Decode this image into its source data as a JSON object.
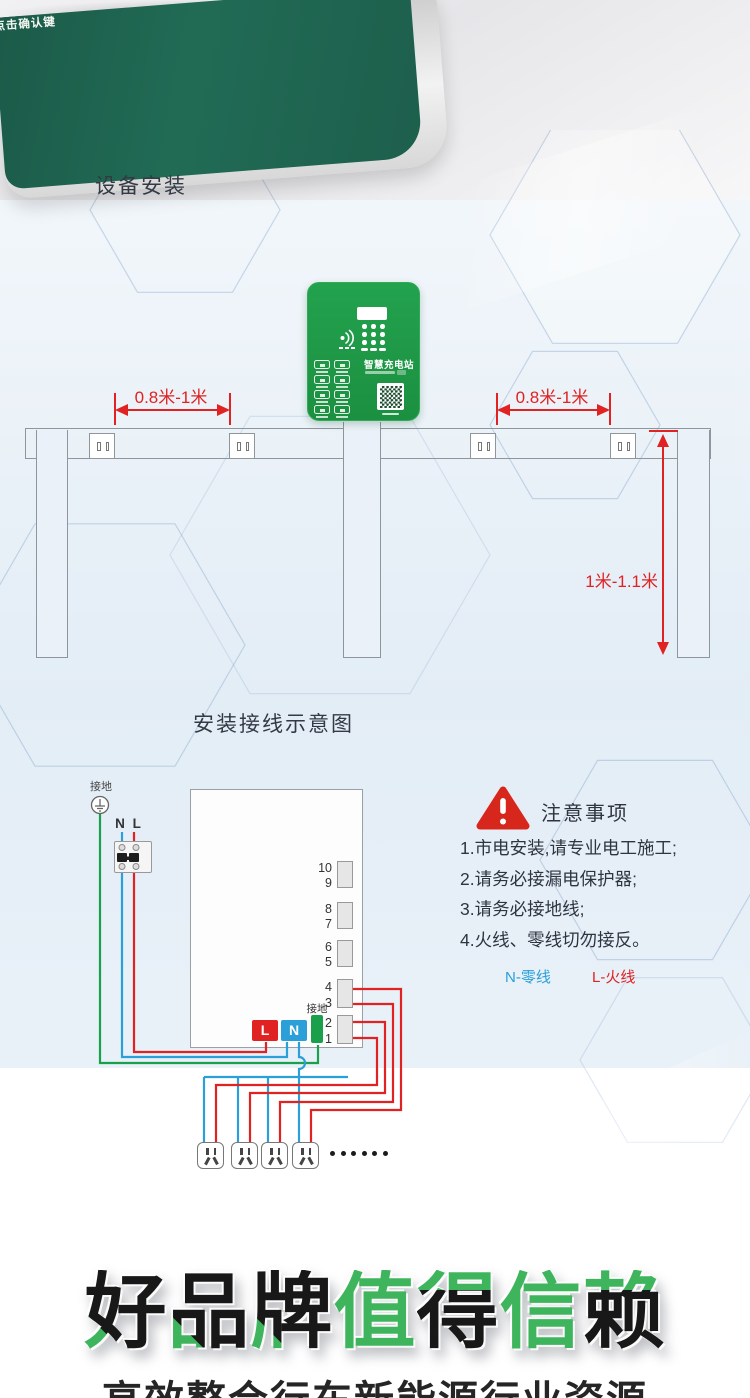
{
  "colors": {
    "brand_green": "#1e9a46",
    "photo_green": "#216b55",
    "dimension_red": "#e02222",
    "wire_blue": "#2b9fd8",
    "wire_green": "#1aa04b",
    "headline_green": "#3eb55c",
    "line_gray": "#8e959d"
  },
  "top_photo": {
    "device_text": "点击确认键"
  },
  "install": {
    "title": "设备安装",
    "device_brand": "智慧充电站",
    "dim_left": "0.8米-1米",
    "dim_right": "0.8米-1米",
    "dim_vertical": "1米-1.1米"
  },
  "wiring": {
    "title": "安装接线示意图",
    "ground_top_label": "接地",
    "nl_label": "N L",
    "terminal_groups": [
      [
        "10",
        "9"
      ],
      [
        "8",
        "7"
      ],
      [
        "6",
        "5"
      ],
      [
        "4",
        "3"
      ],
      [
        "2",
        "1"
      ]
    ],
    "l_terminal": "L",
    "n_terminal": "N",
    "ground_terminal_label": "接地",
    "notice_title": "注意事项",
    "notice_items": [
      "1.市电安装,请专业电工施工;",
      "2.请务必接漏电保护器;",
      "3.请务必接地线;",
      "4.火线、零线切勿接反。"
    ],
    "legend_n": "N-零线",
    "legend_l": "L-火线"
  },
  "footer": {
    "headline": [
      {
        "ch": "好",
        "style": "accent"
      },
      {
        "ch": "品",
        "style": "accent"
      },
      {
        "ch": "牌",
        "style": "accent"
      },
      {
        "ch": "值",
        "style": "green"
      },
      {
        "ch": "得",
        "style": "split"
      },
      {
        "ch": "信",
        "style": "green"
      },
      {
        "ch": "赖",
        "style": "split"
      }
    ],
    "subtitle": "高效整合行车新能源行业资源"
  }
}
